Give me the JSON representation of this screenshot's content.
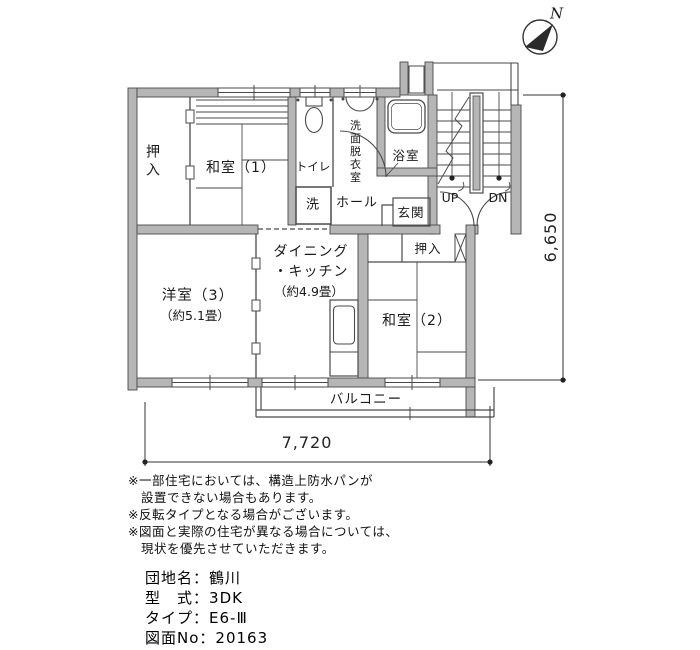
{
  "plan": {
    "labels": {
      "oshiire_1": "押入",
      "washitsu_1": "和室（1）",
      "toilet": "トイレ",
      "laundry": "洗",
      "senmen_datsuiishitsu": "洗面脱衣室",
      "bath": "浴室",
      "hall": "ホール",
      "genkan": "玄関",
      "stairs_up": "UP",
      "stairs_down": "DN",
      "yoshitsu_3": "洋室（3）",
      "yoshitsu_3_area": "（約5.1畳）",
      "dining_kitchen_line1": "ダイニング",
      "dining_kitchen_line2": "・キッチン",
      "dining_kitchen_area": "（約4.9畳）",
      "oshiire_2": "押入",
      "washitsu_2": "和室（2）",
      "balcony": "バルコニー"
    },
    "compass": {
      "north": "N"
    },
    "dimensions": {
      "width_mm": "7,720",
      "height_mm": "6,650"
    }
  },
  "notes": [
    "※一部住宅においては、構造上防水パンが",
    "　設置できない場合もあります。",
    "※反転タイプとなる場合がございます。",
    "※図面と実際の住宅が異なる場合については、",
    "　現状を優先させていただきます。"
  ],
  "info": {
    "rows": [
      {
        "label": "団地名",
        "sep": "：",
        "value": "鶴川"
      },
      {
        "label": "型　式",
        "sep": "：",
        "value": "3DK"
      },
      {
        "label": "タイプ",
        "sep": "：",
        "value": "E6-Ⅲ"
      },
      {
        "label": "図面No",
        "sep": "：",
        "value": "20163"
      }
    ]
  },
  "colors": {
    "wall_fill": "#b6b6b6",
    "line": "#4a4a4a",
    "text": "#1a1a1a",
    "background": "#ffffff"
  }
}
